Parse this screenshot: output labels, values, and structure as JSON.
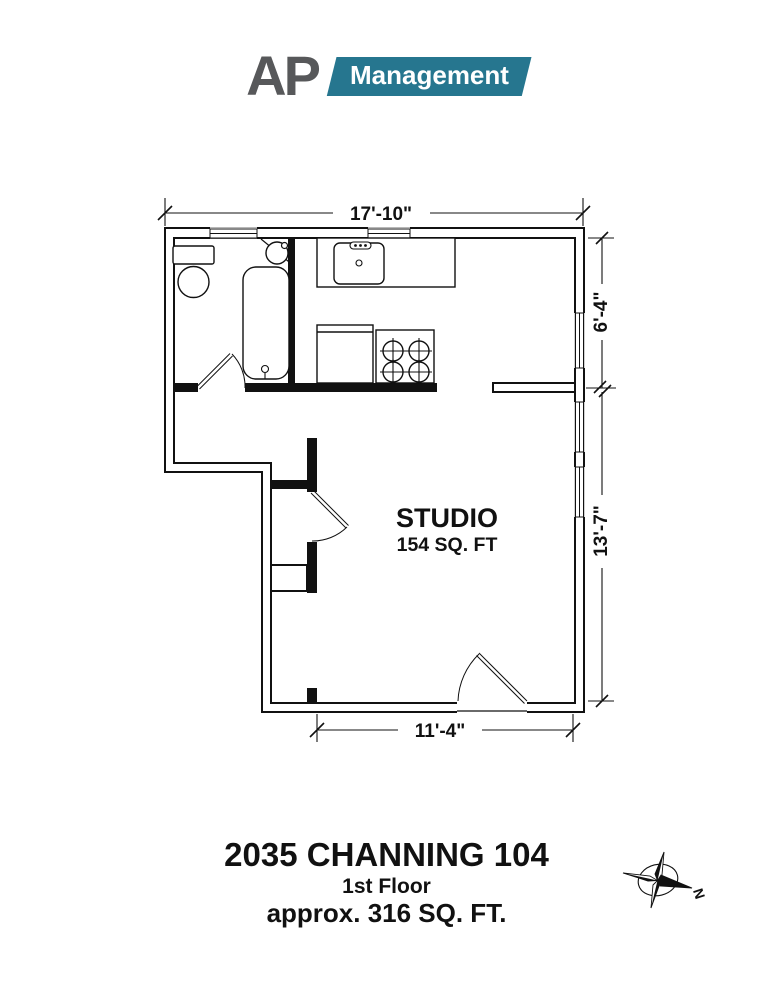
{
  "logo": {
    "prefix": "AP",
    "box_label": "Management",
    "teal": "#26768F",
    "gray": "#57585A"
  },
  "plan": {
    "room_label": "STUDIO",
    "room_area": "154 SQ. FT",
    "dimensions": {
      "top": "17'-10\"",
      "right_upper": "6'-4\"",
      "right_lower": "13'-7\"",
      "bottom": "11'-4\""
    }
  },
  "title_block": {
    "address": "2035 CHANNING 104",
    "floor": "1st Floor",
    "area": "approx. 316 SQ. FT."
  },
  "compass": {
    "north_label": "N"
  },
  "colors": {
    "line": "#111111",
    "background": "#ffffff"
  }
}
